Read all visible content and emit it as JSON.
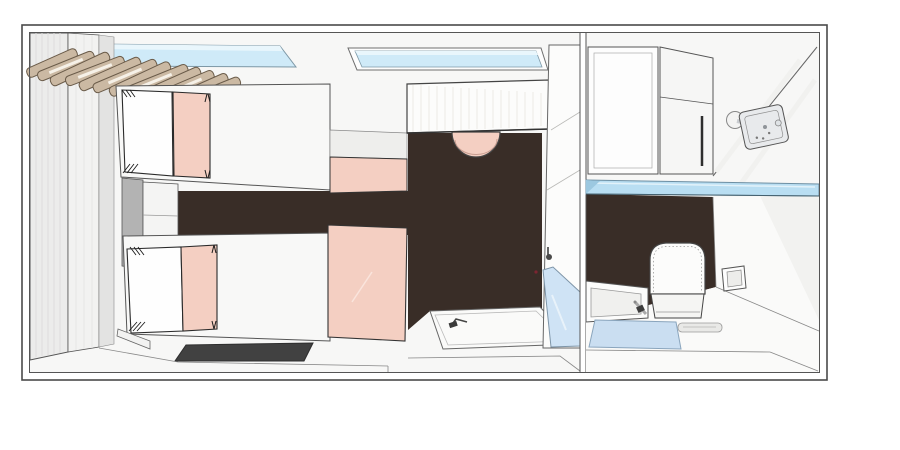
{
  "scene": {
    "type": "top-down-3d-floor-plan",
    "description": "Cutaway top view rendering of a twin cabin with en-suite bathroom",
    "rooms": [
      {
        "name": "bedroom",
        "objects": [
          "wardrobe",
          "wood-slat-canopy",
          "skylight-window-1",
          "skylight-window-2",
          "twin-bed-1",
          "twin-bed-2",
          "pillow",
          "pink-runner",
          "nightstand",
          "bedside-shelf",
          "foot-bench",
          "pink-foot-panel",
          "dark-rug",
          "desk",
          "pink-stool",
          "shower-tray",
          "glass-shower-screen"
        ]
      },
      {
        "name": "bathroom",
        "objects": [
          "overhead-cabinet",
          "shower-mixer-panel",
          "soap-dish",
          "glass-shelf",
          "dark-feature-wall",
          "toilet",
          "toilet-paper-holder",
          "washbasin",
          "faucet",
          "bath-mat",
          "floor-drain",
          "robe-hook"
        ]
      }
    ]
  },
  "palette": {
    "background": "#ffffff",
    "floor_light": "#f7f7f6",
    "wall_stroke": "#4a4a4a",
    "dark_floor": "#392d27",
    "pink": "#f4cfc2",
    "window_blue": "#cfeaf8",
    "window_blue_light": "#e9f6fc",
    "glass_blue": "#cfe3f5",
    "shelf_blue": "#b9def2",
    "mat_blue": "#cadef1",
    "wood": "#cbb9a3",
    "wood_edge": "#6a5b49",
    "wardrobe_gray": "#ececeb",
    "panel_gray": "#e3e3e2",
    "nightstand_gray": "#b3b3b3",
    "rug_dark": "#414141",
    "white_furniture": "#fbfbfa",
    "chrome": "#e8eaec"
  }
}
